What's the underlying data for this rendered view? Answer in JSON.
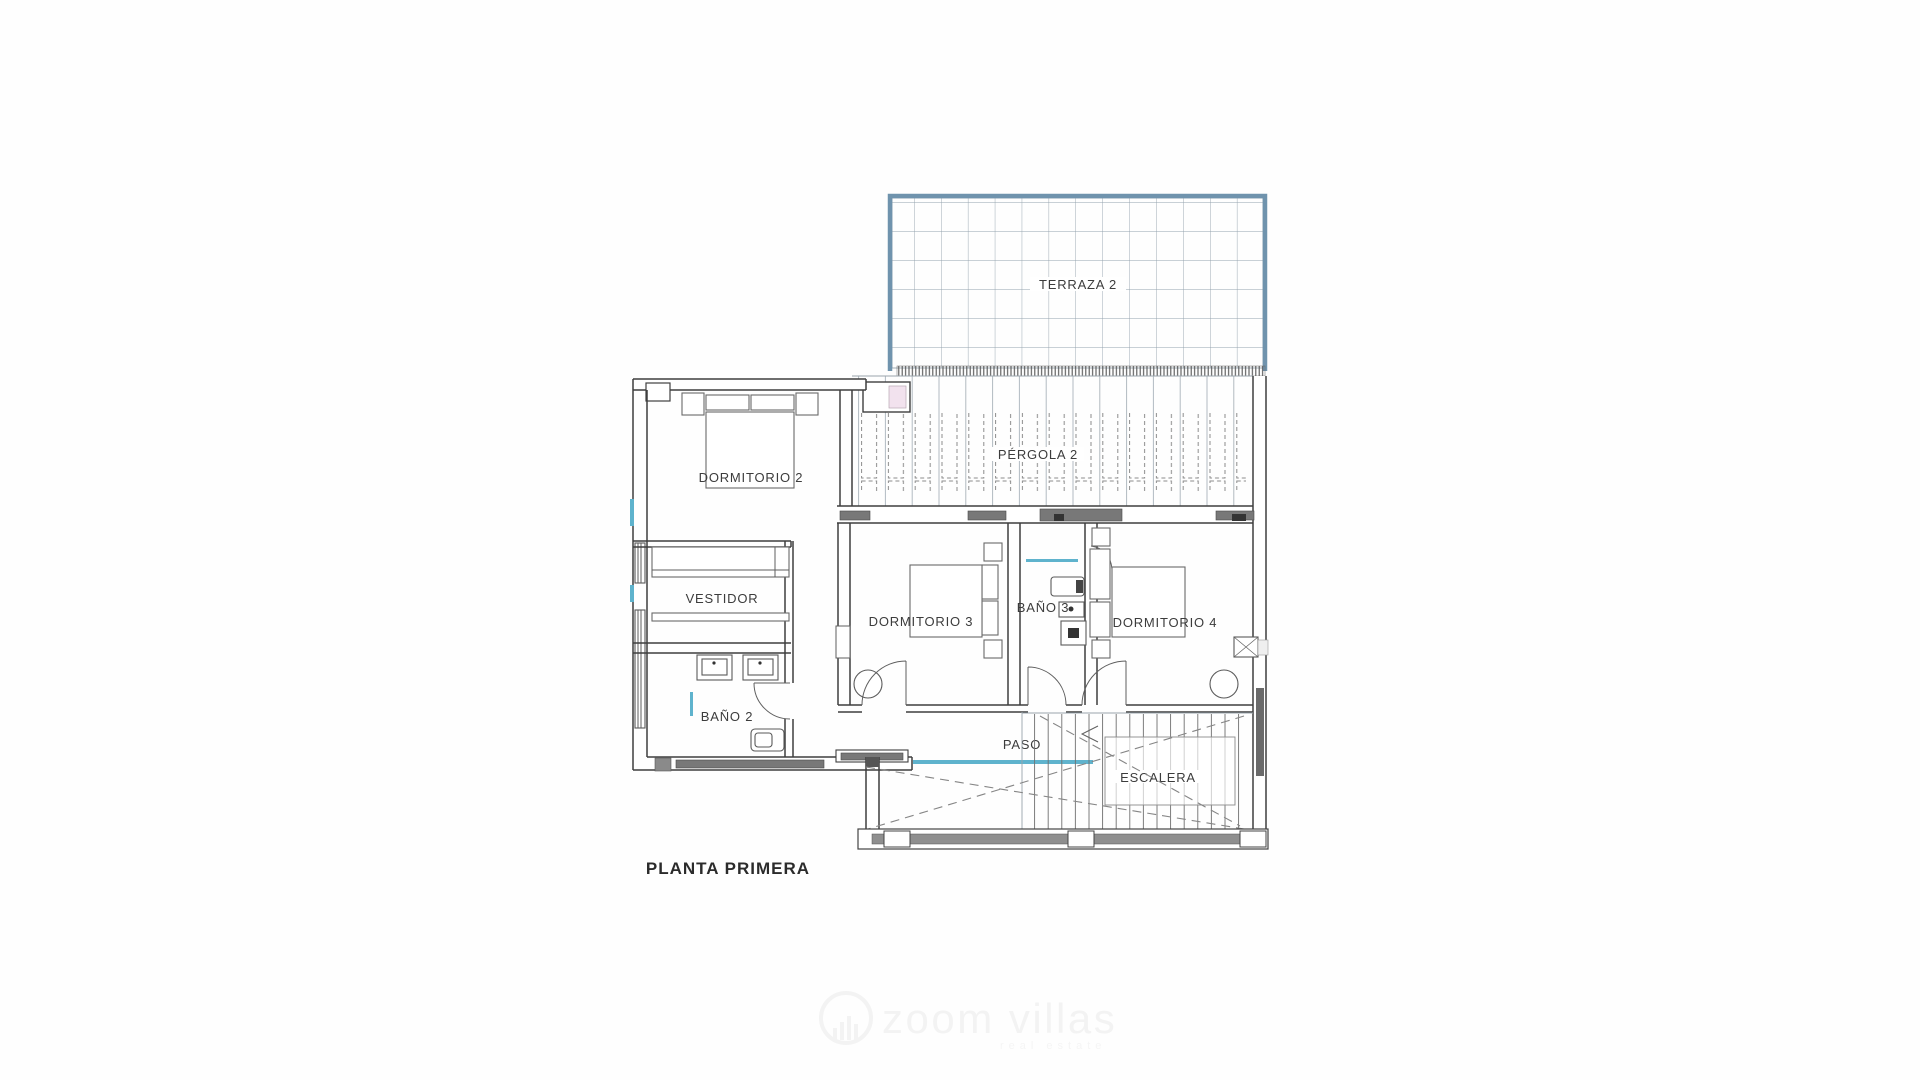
{
  "plan": {
    "title": "PLANTA PRIMERA",
    "rooms": {
      "terraza": "TERRAZA 2",
      "pergola": "PÉRGOLA 2",
      "dormitorio2": "DORMITORIO 2",
      "vestidor": "VESTIDOR",
      "bano2": "BAÑO 2",
      "dormitorio3": "DORMITORIO 3",
      "bano3": "BAÑO 3",
      "dormitorio4": "DORMITORIO 4",
      "paso": "PASO",
      "escalera": "ESCALERA"
    },
    "watermark": {
      "brand": "zoom villas",
      "tagline": "real estate"
    },
    "colors": {
      "terrace_border": "#6f93ad",
      "grid_line": "#93a2ad",
      "wall": "#3f3f3f",
      "accent_cyan": "#5fb3cd",
      "accent_pink": "#f2e2ee",
      "window_fill": "#787878",
      "parapet_fill": "#8f8f8f",
      "label": "#3c3c3c",
      "watermark": "#f3f3f3"
    }
  }
}
